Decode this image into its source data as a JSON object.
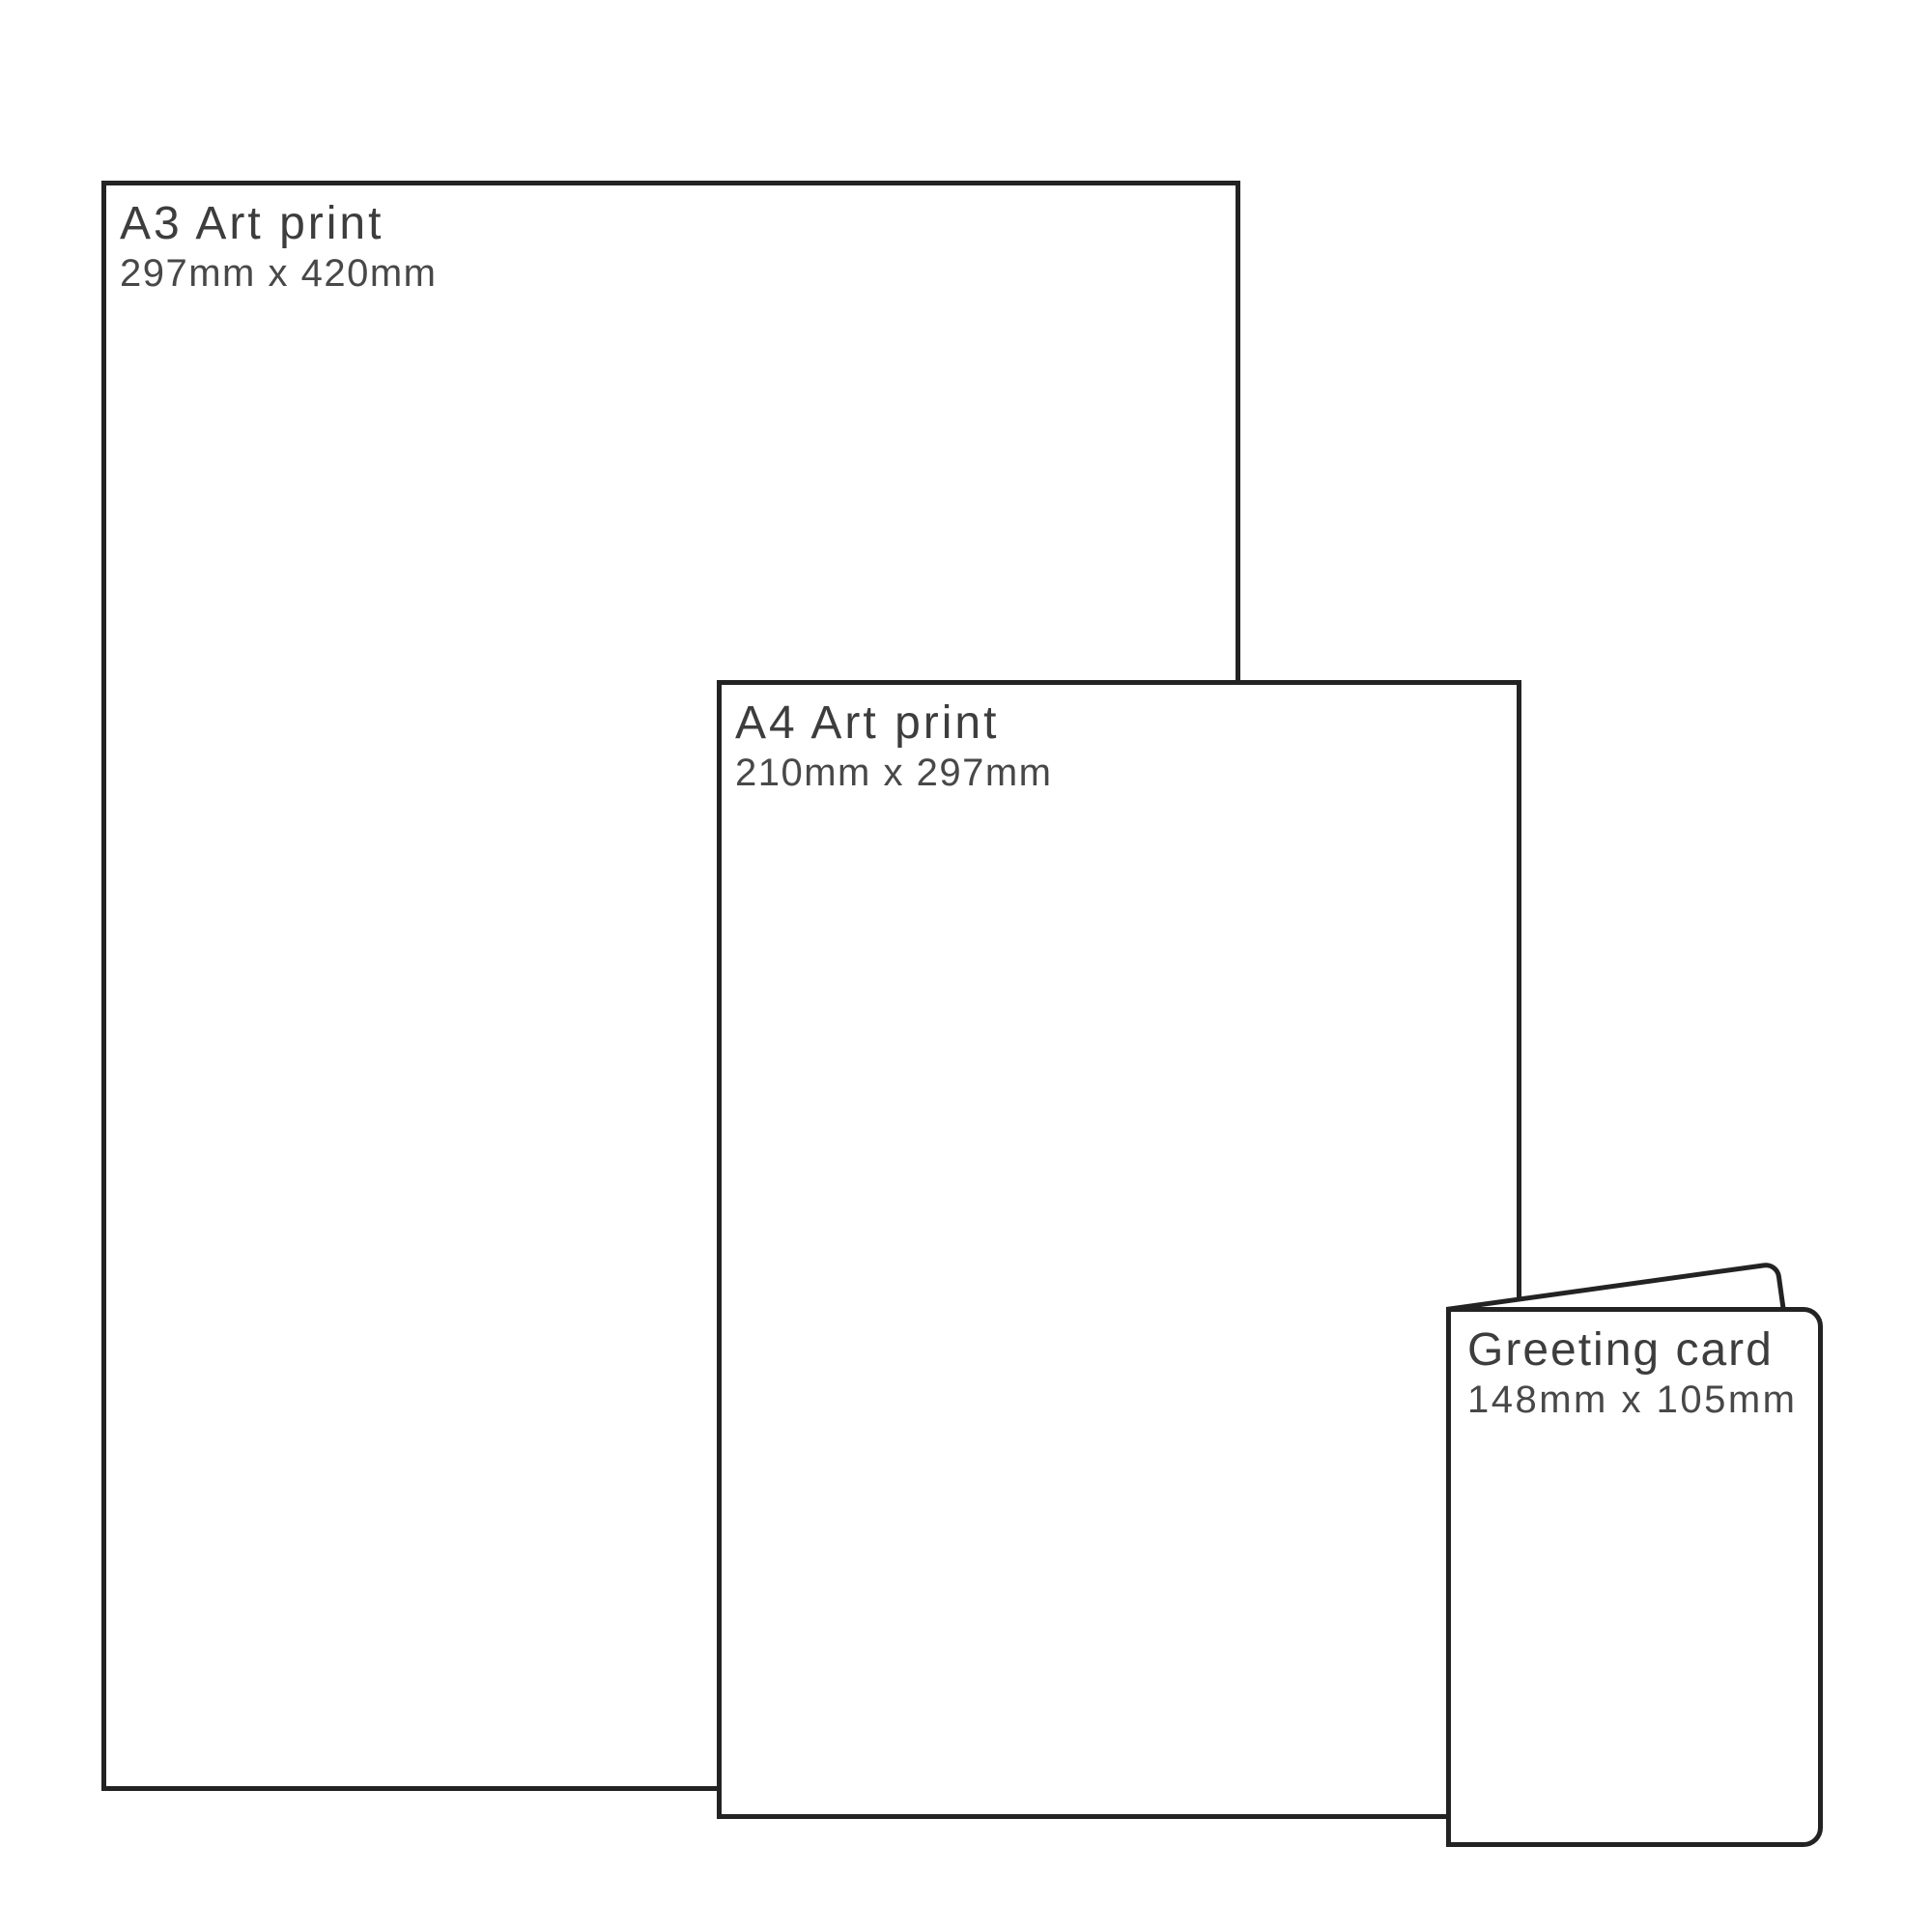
{
  "palette": {
    "background": "#ffffff",
    "outline": "#232323",
    "title_color": "#3d3d3d",
    "dims_color": "#484848"
  },
  "items": [
    {
      "id": "a3-art-print",
      "title": "A3 Art print",
      "size": "297mm x 420mm"
    },
    {
      "id": "a4-art-print",
      "title": "A4 Art print",
      "size": "210mm x 297mm"
    },
    {
      "id": "greeting-card",
      "title": "Greeting card",
      "size": "148mm x 105mm"
    }
  ]
}
